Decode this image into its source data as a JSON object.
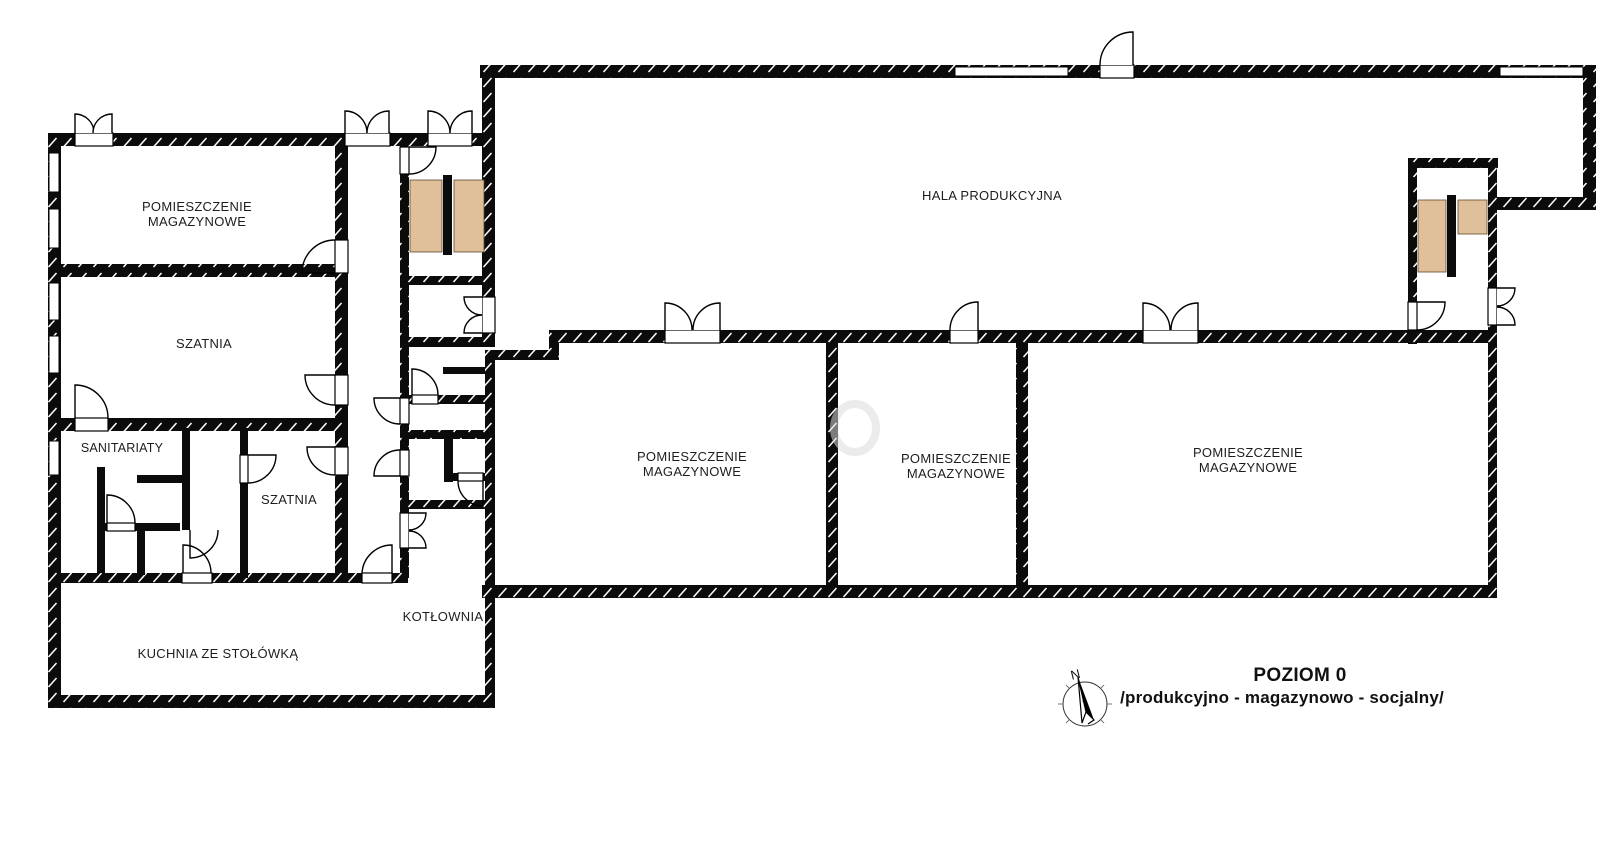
{
  "plan": {
    "rooms": {
      "storage_top_left": {
        "line1": "POMIESZCZENIE",
        "line2": "MAGAZYNOWE"
      },
      "szatnia_upper": {
        "label": "SZATNIA"
      },
      "sanitariaty": {
        "label": "SANITARIATY"
      },
      "szatnia_lower": {
        "label": "SZATNIA"
      },
      "kuchnia": {
        "label": "KUCHNIA ZE STOŁÓWKĄ"
      },
      "kotlownia": {
        "label": "KOTŁOWNIA"
      },
      "hala": {
        "label": "HALA PRODUKCYJNA"
      },
      "storage_mid_left": {
        "line1": "POMIESZCZENIE",
        "line2": "MAGAZYNOWE"
      },
      "storage_mid_center": {
        "line1": "POMIESZCZENIE",
        "line2": "MAGAZYNOWE"
      },
      "storage_mid_right": {
        "line1": "POMIESZCZENIE",
        "line2": "MAGAZYNOWE"
      }
    },
    "title_block": {
      "level": "POZIOM 0",
      "subtitle": "/produkcyjno - magazynowo - socjalny/"
    },
    "compass": {
      "north": "N"
    },
    "colors": {
      "wall": "#0b0b0b",
      "stair_fill": "#e0c09a",
      "background": "#ffffff",
      "text": "#1d1d1d"
    }
  }
}
